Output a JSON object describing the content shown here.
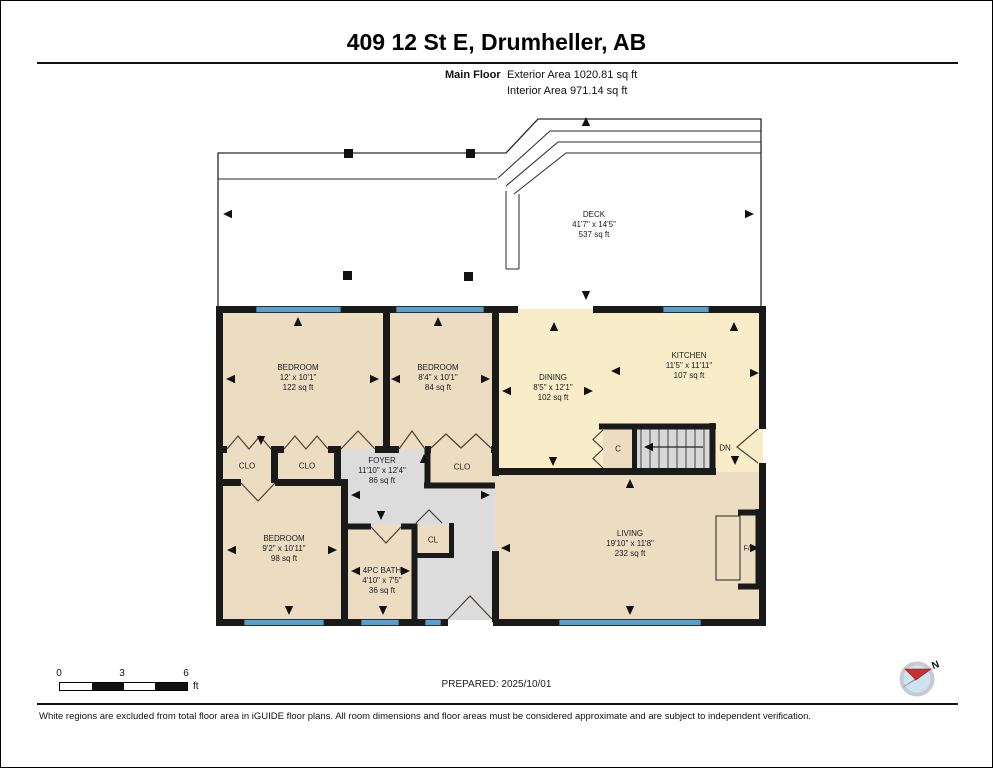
{
  "palette": {
    "room_tan": "#ECDCC2",
    "room_yellow": "#F8EDC8",
    "hall_gray": "#DCDCDC",
    "stair_gray": "#D8D8D8",
    "window_blue": "#5AA0CD",
    "wall_black": "#1A1A1A",
    "deck_white": "#FFFFFF"
  },
  "header": {
    "title": "409 12 St E, Drumheller, AB",
    "floor_label": "Main Floor",
    "exterior_area": "Exterior Area 1020.81 sq ft",
    "interior_area": "Interior Area 971.14 sq ft"
  },
  "rooms": {
    "deck": {
      "name": "DECK",
      "dims": "41'7\" x 14'5\"",
      "area": "537 sq ft"
    },
    "bedroom1": {
      "name": "BEDROOM",
      "dims": "12' x 10'1\"",
      "area": "122 sq ft"
    },
    "bedroom2": {
      "name": "BEDROOM",
      "dims": "8'4\" x 10'1\"",
      "area": "84 sq ft"
    },
    "dining": {
      "name": "DINING",
      "dims": "8'5\" x 12'1\"",
      "area": "102 sq ft"
    },
    "kitchen": {
      "name": "KITCHEN",
      "dims": "11'5\" x 11'11\"",
      "area": "107 sq ft"
    },
    "foyer": {
      "name": "FOYER",
      "dims": "11'10\" x 12'4\"",
      "area": "86 sq ft"
    },
    "bedroom3": {
      "name": "BEDROOM",
      "dims": "9'2\" x 10'11\"",
      "area": "98 sq ft"
    },
    "bath": {
      "name": "4PC BATH",
      "dims": "4'10\" x 7'5\"",
      "area": "36 sq ft"
    },
    "living": {
      "name": "LIVING",
      "dims": "19'10\" x 11'8\"",
      "area": "232 sq ft"
    }
  },
  "labels": {
    "closet1": "CLO",
    "closet2": "CLO",
    "closet_bed2": "CLO",
    "closet_stairs": "C",
    "closet_bath": "CL",
    "stairs_down": "DN",
    "fireplace": "F/P"
  },
  "scale_bar": {
    "tick_0": "0",
    "tick_3": "3",
    "tick_6": "6",
    "unit": "ft"
  },
  "prepared_label": "PREPARED: 2025/10/01",
  "compass": {
    "north_label": "N"
  },
  "footer": {
    "disclaimer": "White regions are excluded from total floor area in iGUIDE floor plans. All room dimensions and floor areas must be considered approximate and are subject to independent verification."
  }
}
